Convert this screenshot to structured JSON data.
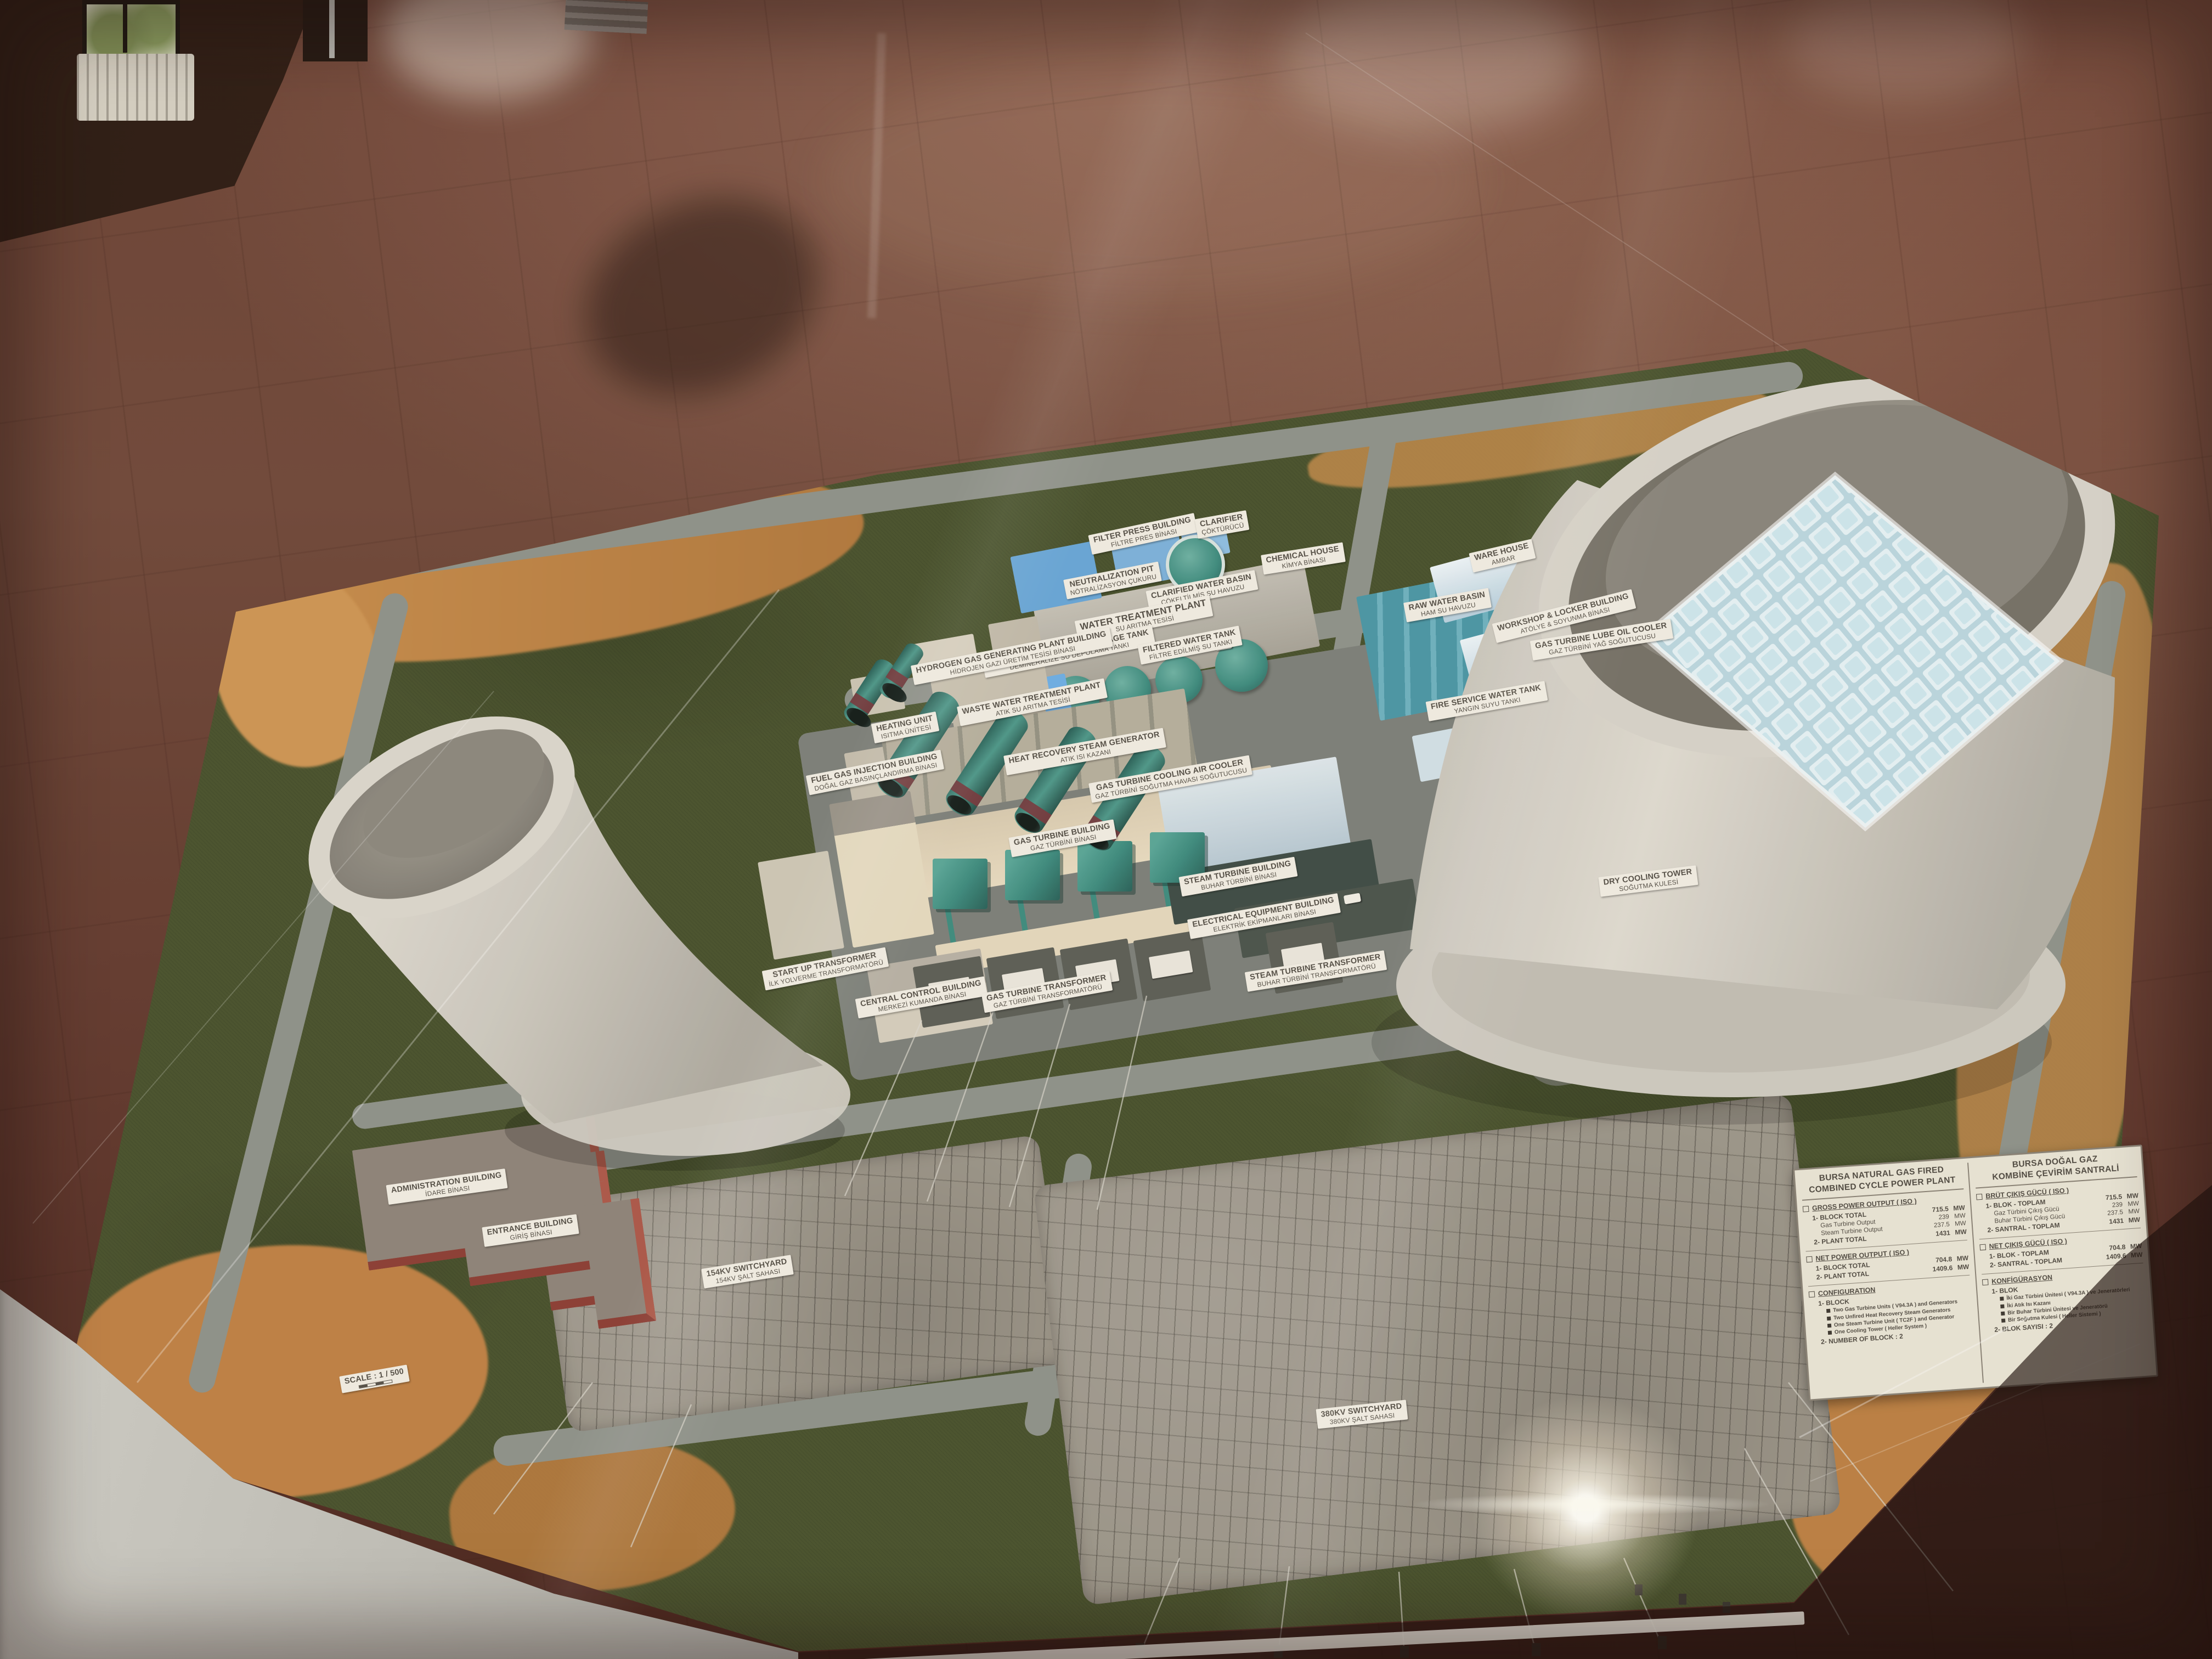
{
  "colors": {
    "grass": "#4a5530",
    "dirt": "#c0854a",
    "road": "#8f948d",
    "switchyard_gravel": "#9d988d",
    "teal_equipment": "#3f8e82",
    "chimney_band": "#7c3d42",
    "cream_building": "#e6dcc2",
    "warehouse_blue": "#cfe3ee",
    "brick_red": "#ad5a4c",
    "tower_concrete": "#cfccc3",
    "heller_grid": "#dceef4",
    "placard_paper": "#eae6d8",
    "placard_ink": "#514d45",
    "label_paper": "#f2efe5",
    "floor": "#6d4438",
    "glass_frame": "#b8b8b2"
  },
  "model_labels": [
    {
      "en": "FILTER PRESS BUILDING",
      "tr": "FİLTRE PRES BİNASI"
    },
    {
      "en": "CLARIFIER",
      "tr": "ÇÖKTÜRÜCÜ"
    },
    {
      "en": "CHEMICAL HOUSE",
      "tr": "KİMYA BİNASI"
    },
    {
      "en": "NEUTRALIZATION PIT",
      "tr": "NÖTRALİZASYON ÇUKURU"
    },
    {
      "en": "CLARIFIED WATER BASIN",
      "tr": "ÇÖKELTİLMİŞ SU HAVUZU"
    },
    {
      "en": "WATER TREATMENT PLANT",
      "tr": "SU ARITMA TESİSİ"
    },
    {
      "en": "RAW WATER BASIN",
      "tr": "HAM SU HAVUZU"
    },
    {
      "en": "DEMINERALIZED WATER STORAGE TANK",
      "tr": "DEMİNERALİZE SU DEPOLAMA TANKI"
    },
    {
      "en": "FILTERED WATER TANK",
      "tr": "FİLTRE EDİLMİŞ SU TANKI"
    },
    {
      "en": "FIRE SERVICE WATER TANK",
      "tr": "YANGIN SUYU TANKI"
    },
    {
      "en": "WARE HOUSE",
      "tr": "AMBAR"
    },
    {
      "en": "WORKSHOP & LOCKER BUILDING",
      "tr": "ATÖLYE & SOYUNMA BİNASI"
    },
    {
      "en": "HYDROGEN GAS GENERATING PLANT BUILDING",
      "tr": "HİDROJEN GAZI ÜRETİM TESİSİ BİNASI"
    },
    {
      "en": "WASTE WATER TREATMENT PLANT",
      "tr": "ATIK SU ARITMA TESİSİ"
    },
    {
      "en": "HEATING UNIT",
      "tr": "ISITMA ÜNİTESİ"
    },
    {
      "en": "FUEL GAS INJECTION BUILDING",
      "tr": "DOĞAL GAZ BASINÇLANDIRMA BİNASI"
    },
    {
      "en": "HEAT RECOVERY STEAM GENERATOR",
      "tr": "ATIK ISI KAZANI"
    },
    {
      "en": "GAS TURBINE COOLING AIR COOLER",
      "tr": "GAZ TÜRBİNİ SOĞUTMA HAVASI SOĞUTUCUSU"
    },
    {
      "en": "GAS TURBINE BUILDING",
      "tr": "GAZ TÜRBİNİ BİNASI"
    },
    {
      "en": "STEAM TURBINE BUILDING",
      "tr": "BUHAR TÜRBİNİ BİNASI"
    },
    {
      "en": "CENTRAL CONTROL BUILDING",
      "tr": "MERKEZİ KUMANDA BİNASI"
    },
    {
      "en": "START UP TRANSFORMER",
      "tr": "İLK YOLVERME TRANSFORMATÖRÜ"
    },
    {
      "en": "ELECTRICAL EQUIPMENT BUILDING",
      "tr": "ELEKTRİK EKİPMANLARI BİNASI"
    },
    {
      "en": "STEAM TURBINE TRANSFORMER",
      "tr": "BUHAR TÜRBİNİ TRANSFORMATÖRÜ"
    },
    {
      "en": "GAS TURBINE TRANSFORMER",
      "tr": "GAZ TÜRBİNİ TRANSFORMATÖRÜ"
    },
    {
      "en": "GAS TURBINE LUBE OIL COOLER",
      "tr": "GAZ TÜRBİNİ YAĞ SOĞUTUCUSU"
    },
    {
      "en": "ADMINISTRATION BUILDING",
      "tr": "İDARE BİNASI"
    },
    {
      "en": "ENTRANCE BUILDING",
      "tr": "GİRİŞ BİNASI"
    },
    {
      "en": "154KV SWITCHYARD",
      "tr": "154KV ŞALT SAHASI"
    },
    {
      "en": "380KV SWITCHYARD",
      "tr": "380KV ŞALT SAHASI"
    },
    {
      "en": "DRY COOLING TOWER",
      "tr": "SOĞUTMA KULESİ"
    },
    {
      "en": "SCALE : 1 / 500",
      "tr": ""
    }
  ],
  "placard": {
    "title_en_1": "BURSA NATURAL GAS FIRED",
    "title_en_2": "COMBINED CYCLE POWER PLANT",
    "title_tr_1": "BURSA DOĞAL GAZ",
    "title_tr_2": "KOMBİNE ÇEVİRİM SANTRALİ",
    "gross": {
      "heading_en": "GROSS POWER OUTPUT ( ISO )",
      "heading_tr": "BRÜT ÇIKIŞ GÜCÜ ( ISO )",
      "rows": [
        {
          "en": "1- BLOCK TOTAL",
          "tr": "1- BLOK - TOPLAM",
          "val": "715.5",
          "unit": "MW"
        },
        {
          "en": "Gas Turbine Output",
          "tr": "Gaz Türbini Çıkış Gücü",
          "val": "239",
          "unit": "MW"
        },
        {
          "en": "Steam Turbine Output",
          "tr": "Buhar Türbini Çıkış Gücü",
          "val": "237.5",
          "unit": "MW"
        },
        {
          "en": "2- PLANT TOTAL",
          "tr": "2- SANTRAL - TOPLAM",
          "val": "1431",
          "unit": "MW"
        }
      ]
    },
    "net": {
      "heading_en": "NET POWER OUTPUT ( ISO )",
      "heading_tr": "NET ÇIKIŞ GÜCÜ ( ISO )",
      "rows": [
        {
          "en": "1- BLOCK TOTAL",
          "tr": "1- BLOK - TOPLAM",
          "val": "704.8",
          "unit": "MW"
        },
        {
          "en": "2- PLANT TOTAL",
          "tr": "2- SANTRAL - TOPLAM",
          "val": "1409.6",
          "unit": "MW"
        }
      ]
    },
    "config": {
      "heading_en": "CONFIGURATION",
      "heading_tr": "KONFİGÜRASYON",
      "block_en": "1- BLOCK",
      "block_tr": "1- BLOK",
      "bullets_en": [
        "Two Gas Turbine Units ( V94.3A ) and Generators",
        "Two Unfired Heat Recovery Steam Generators",
        "One Steam Turbine Unit ( TC2F ) and Generator",
        "One Cooling Tower ( Heller System )"
      ],
      "bullets_tr": [
        "İki Gaz Türbini Ünitesi ( V94.3A ) ve Jeneratörleri",
        "İki Atık Isı Kazanı",
        "Bir Buhar Türbini Ünitesi ve Jeneratörü",
        "Bir Soğutma Kulesi ( Heller Sistemi )"
      ],
      "count_en": "2- NUMBER OF BLOCK : 2",
      "count_tr": "2- BLOK SAYISI : 2"
    }
  }
}
